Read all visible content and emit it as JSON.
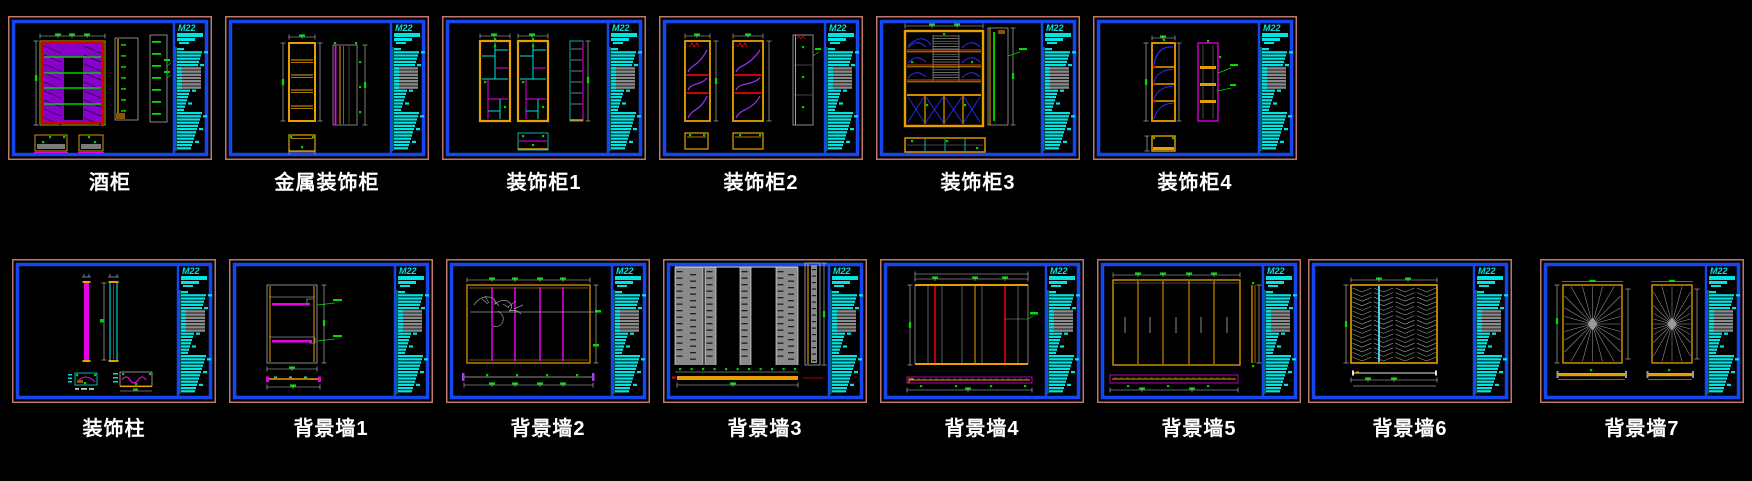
{
  "sheet": {
    "background": "#000000"
  },
  "title_block": {
    "logo": "M22"
  },
  "colors": {
    "border_outer": "#c1766b",
    "border_inner": "#1547ee",
    "titleblock_cyan": "#00e4e4",
    "label_text": "#ffffff",
    "dim_line": "#c8c8c8",
    "dim_tick_green": "#00dc00",
    "cad_yellow": "#e8a000",
    "cad_red": "#e80000",
    "cad_magenta": "#e800e8",
    "cad_cyan": "#00e0e0",
    "cad_green": "#00d000",
    "cad_purple": "#9b30ff",
    "cad_blue": "#2a2af8",
    "cad_gray": "#8a8a8a",
    "cad_hatch_purple": "#8800cc",
    "cad_white": "#d8d8d8"
  },
  "rows": [
    {
      "name": "cabinets",
      "panels": [
        {
          "label": "酒柜",
          "kind": "wine_cabinet"
        },
        {
          "label": "金属装饰柜",
          "kind": "metal_cabinet"
        },
        {
          "label": "装饰柜1",
          "kind": "deco_cabinet_1"
        },
        {
          "label": "装饰柜2",
          "kind": "deco_cabinet_2"
        },
        {
          "label": "装饰柜3",
          "kind": "deco_cabinet_3"
        },
        {
          "label": "装饰柜4",
          "kind": "deco_cabinet_4"
        }
      ]
    },
    {
      "name": "walls",
      "panels": [
        {
          "label": "装饰柱",
          "kind": "deco_column"
        },
        {
          "label": "背景墙1",
          "kind": "bg_wall_1"
        },
        {
          "label": "背景墙2",
          "kind": "bg_wall_2"
        },
        {
          "label": "背景墙3",
          "kind": "bg_wall_3"
        },
        {
          "label": "背景墙4",
          "kind": "bg_wall_4"
        },
        {
          "label": "背景墙5",
          "kind": "bg_wall_5"
        },
        {
          "label": "背景墙6",
          "kind": "bg_wall_6"
        },
        {
          "label": "背景墙7",
          "kind": "bg_wall_7"
        }
      ]
    }
  ]
}
